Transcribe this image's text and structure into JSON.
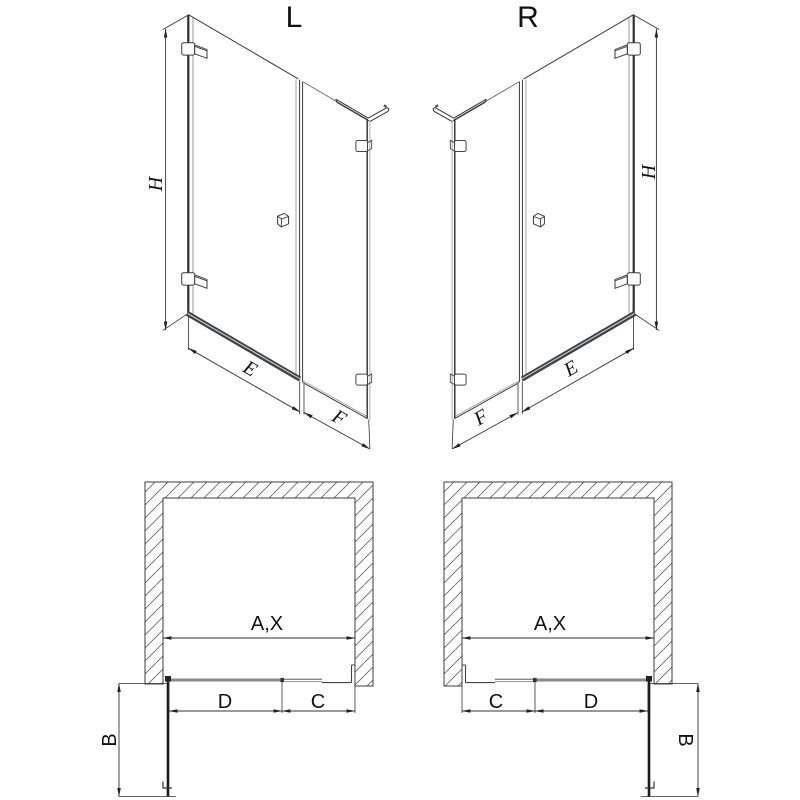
{
  "document": {
    "type": "shower-enclosure-dimension-drawing",
    "background": "#ffffff"
  },
  "views": {
    "elevation_left": {
      "title": "L",
      "labels": {
        "height": "H",
        "door_width": "E",
        "panel_width": "F"
      }
    },
    "elevation_right": {
      "title": "R",
      "labels": {
        "height": "H",
        "door_width": "E",
        "panel_width": "F"
      }
    },
    "plan_left": {
      "labels": {
        "opening_width": "A,X",
        "door_width": "D",
        "panel_width": "C",
        "door_projection": "B"
      }
    },
    "plan_right": {
      "labels": {
        "opening_width": "A,X",
        "door_width": "D",
        "panel_width": "C",
        "door_projection": "B"
      }
    }
  },
  "colors": {
    "line_dark": "#2e2e2e",
    "line_medium": "#3a3a3a",
    "line_gray": "#999999",
    "dimension_line": "#333333",
    "arrow_fill": "#222222",
    "threshold_bar": "#3f4347",
    "threshold_highlight": "#c9ccd0",
    "plan_threshold_gray": "#8a8a8a",
    "hatch_line": "#666666",
    "text": "#111111",
    "background": "#ffffff"
  }
}
